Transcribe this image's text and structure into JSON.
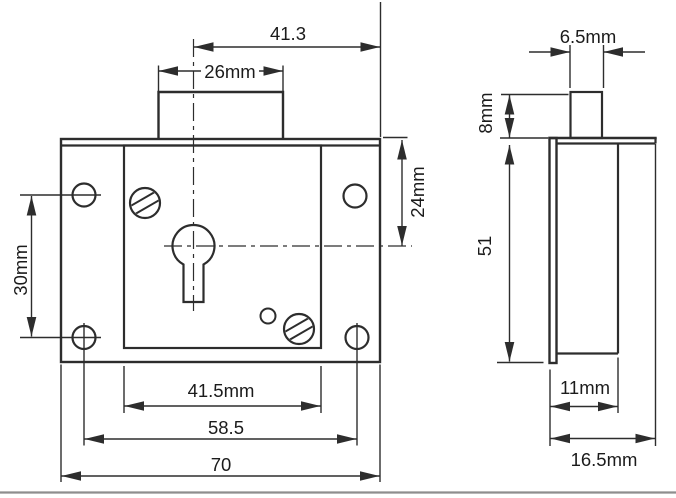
{
  "drawing": {
    "background": "#ffffff",
    "line_color": "#2d2d2d",
    "text_color": "#1b1b1b",
    "rule_color": "#8e8e8e",
    "front_view": {
      "dim_center_to_edge": "41.3",
      "dim_tab_width": "26mm",
      "dim_top_to_center": "24mm",
      "dim_hole_pitch_vertical": "30mm",
      "dim_case_width": "41.5mm",
      "dim_hole_pitch_horizontal": "58.5",
      "dim_overall_width": "70"
    },
    "side_view": {
      "dim_bolt_width": "6.5mm",
      "dim_bolt_projection": "8mm",
      "dim_height": "51",
      "dim_case_depth": "11mm",
      "dim_overall_depth": "16.5mm"
    }
  }
}
